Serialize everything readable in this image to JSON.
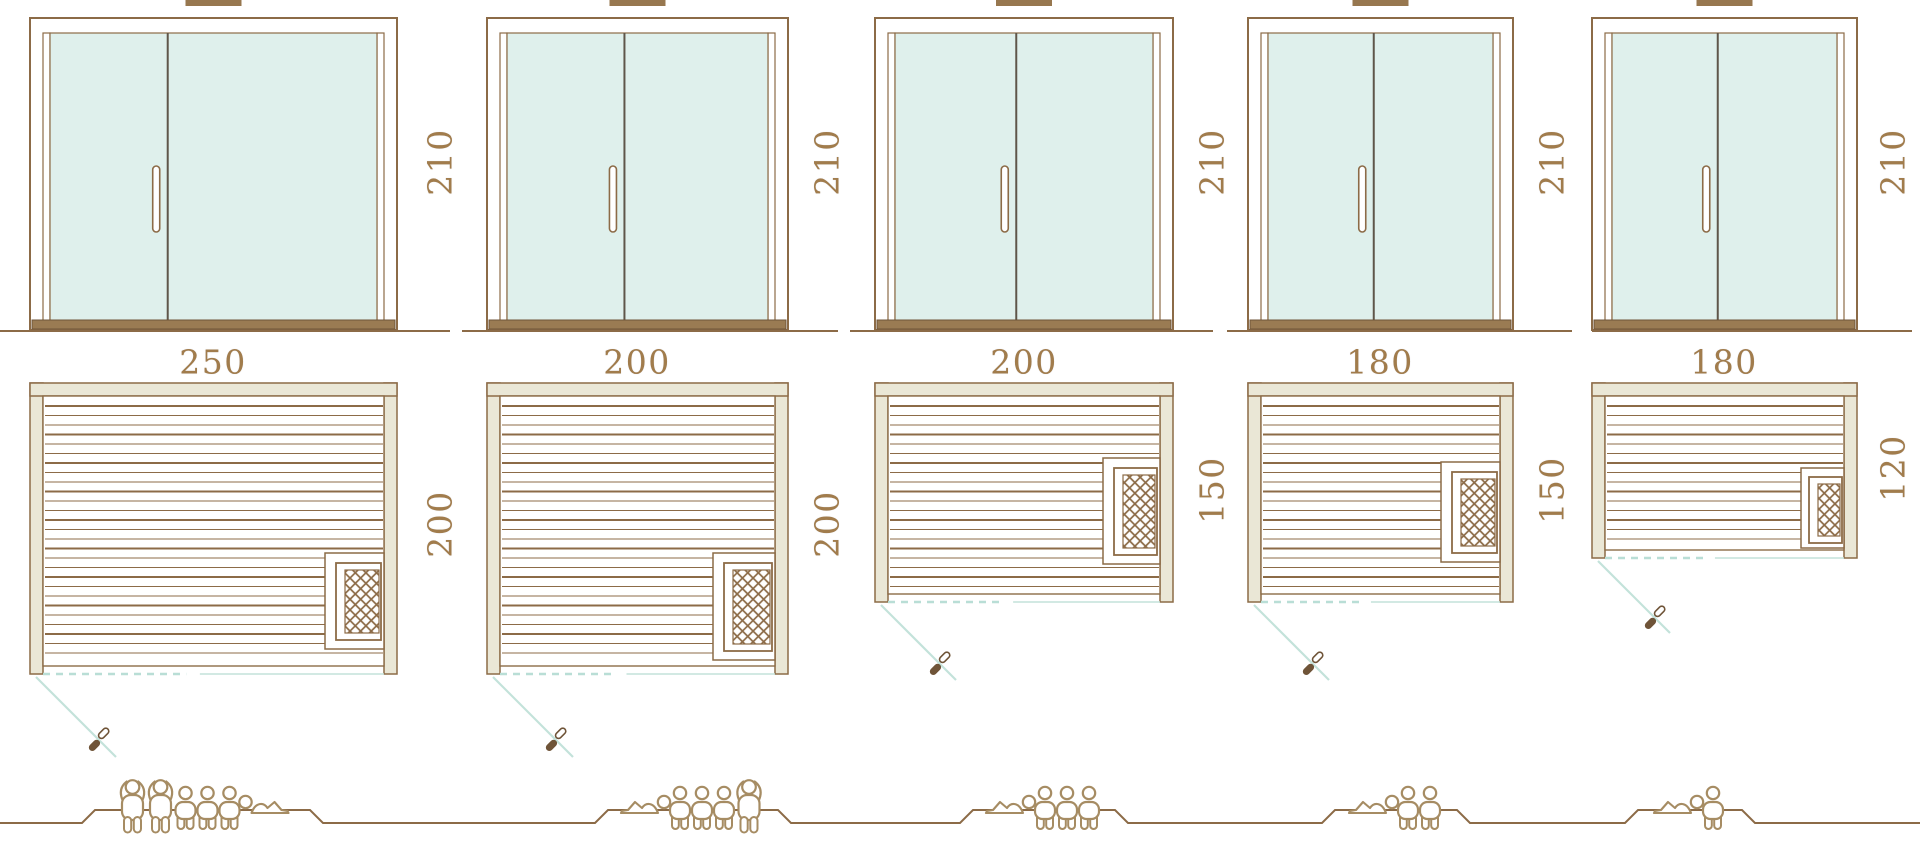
{
  "diagram": {
    "type": "sauna-size-comparison",
    "colors": {
      "line_brown": "#8c6b47",
      "line_brown_dark": "#6f5438",
      "wall_fill": "#eae7d6",
      "glass_fill": "#dff0ec",
      "divider": "#5f564a",
      "threshold_fill": "#9a7b53",
      "tab_fill": "#97774f",
      "door_swing_teal": "#c3e2da",
      "dashed_teal": "#b9ded6",
      "dimension_text": "#a17c4c",
      "people_line": "#a68c63",
      "white": "#ffffff"
    },
    "units": [
      {
        "name": "sauna-250x200",
        "door_height_label": "210",
        "door_height_cm": 210,
        "width_label": "250",
        "width_cm": 250,
        "depth_label": "200",
        "depth_cm": 200,
        "capacity": {
          "standing": 2,
          "seated": 3,
          "reclining": 1,
          "total": 6
        },
        "figures": [
          "standing",
          "standing",
          "seated",
          "seated",
          "seated",
          "reclining-right"
        ]
      },
      {
        "name": "sauna-200x200",
        "door_height_label": "210",
        "door_height_cm": 210,
        "width_label": "200",
        "width_cm": 200,
        "depth_label": "200",
        "depth_cm": 200,
        "capacity": {
          "standing": 1,
          "seated": 3,
          "reclining": 1,
          "total": 5
        },
        "figures": [
          "reclining-left",
          "seated",
          "seated",
          "seated",
          "standing"
        ]
      },
      {
        "name": "sauna-200x150",
        "door_height_label": "210",
        "door_height_cm": 210,
        "width_label": "200",
        "width_cm": 200,
        "depth_label": "150",
        "depth_cm": 150,
        "capacity": {
          "standing": 0,
          "seated": 3,
          "reclining": 1,
          "total": 4
        },
        "figures": [
          "reclining-left",
          "seated",
          "seated",
          "seated"
        ]
      },
      {
        "name": "sauna-180x150",
        "door_height_label": "210",
        "door_height_cm": 210,
        "width_label": "180",
        "width_cm": 180,
        "depth_label": "150",
        "depth_cm": 150,
        "capacity": {
          "standing": 0,
          "seated": 2,
          "reclining": 1,
          "total": 3
        },
        "figures": [
          "reclining-left",
          "seated",
          "seated"
        ]
      },
      {
        "name": "sauna-180x120",
        "door_height_label": "210",
        "door_height_cm": 210,
        "width_label": "180",
        "width_cm": 180,
        "depth_label": "120",
        "depth_cm": 120,
        "capacity": {
          "standing": 0,
          "seated": 1,
          "reclining": 1,
          "total": 2
        },
        "figures": [
          "reclining-left",
          "seated"
        ]
      }
    ]
  }
}
